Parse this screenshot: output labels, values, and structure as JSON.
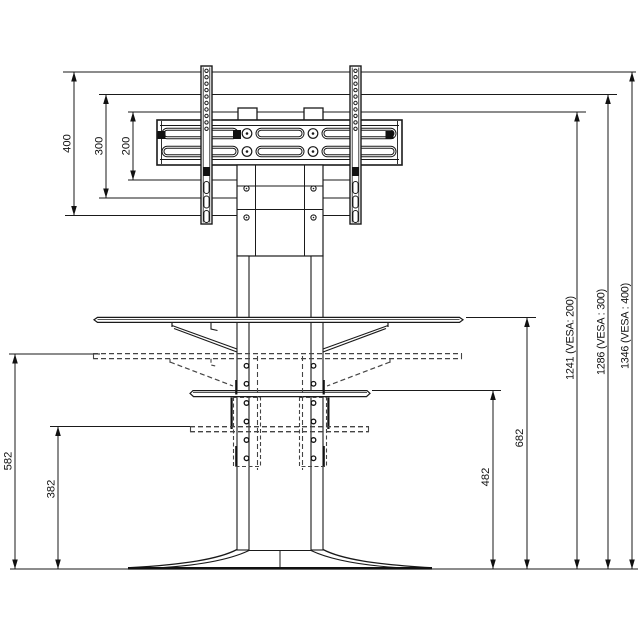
{
  "style": {
    "background": "#ffffff",
    "line_color": "#1a1a1a",
    "text_color": "#111111"
  },
  "drawing": {
    "subject": "tv-stand-with-vesa-mount-dimensional-drawing"
  },
  "dimensions": {
    "d400": "400",
    "d300": "300",
    "d200": "200",
    "d582": "582",
    "d382": "382",
    "d682": "682",
    "d482": "482",
    "d1241": "1241 (VESA:  200)",
    "d1286": "1286 (VESA : 300)",
    "d1346": "1346 (VESA : 400)"
  }
}
